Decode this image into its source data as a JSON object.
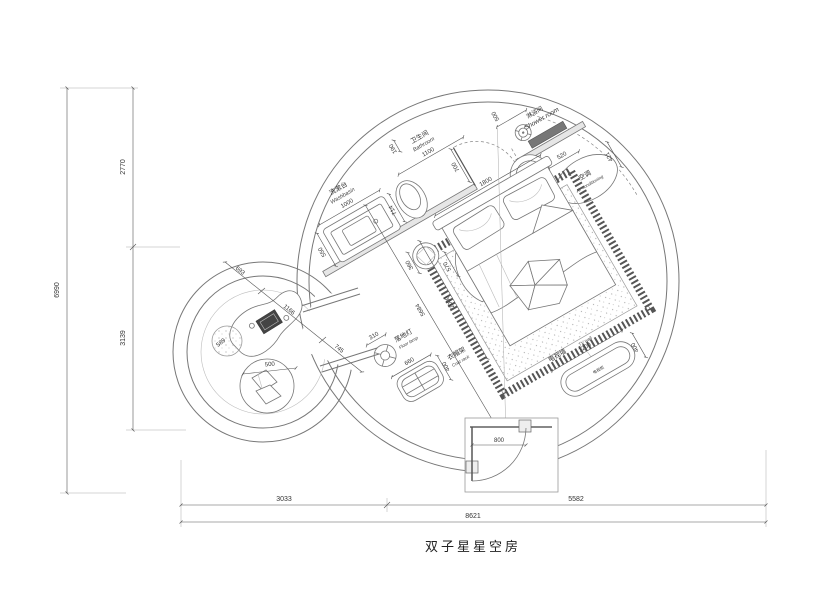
{
  "title": "双子星星空房",
  "dims": {
    "total_height": "6990",
    "upper_height": "2770",
    "lower_height": "3139",
    "left_width": "3033",
    "right_width": "5582",
    "total_width": "8621"
  },
  "washbasin": {
    "cn": "洗漱台",
    "en": "Washbasin",
    "width": "1000",
    "depth": "550",
    "toilet_offset": "714"
  },
  "bathroom": {
    "cn": "卫生间",
    "en": "Bathroom",
    "width": "1100",
    "door": "700",
    "wall_gap": "190",
    "shower_gap": "590"
  },
  "shower": {
    "cn": "淋浴间",
    "en": "Shower room",
    "width": "500"
  },
  "ac": {
    "cn": "空调",
    "en": "Air conditioning",
    "width": "520",
    "depth": "421"
  },
  "bed": {
    "width": "1800",
    "length": "2000",
    "diagonal": "5684",
    "stool": "360",
    "stool_offset": "570"
  },
  "tv": {
    "cn": "电视墙",
    "en": "TV wall",
    "width": "1200",
    "depth": "400",
    "cabinet": "电视柜"
  },
  "lamp": {
    "cn": "落地灯",
    "en": "Floor lamp",
    "size": "310"
  },
  "coat": {
    "cn": "衣帽架",
    "en": "Coat rack",
    "width": "660",
    "depth": "400"
  },
  "entrance": {
    "door": "800"
  },
  "lounge": {
    "a": "693",
    "b": "1166",
    "c": "745",
    "table": "589",
    "chair": "500"
  }
}
